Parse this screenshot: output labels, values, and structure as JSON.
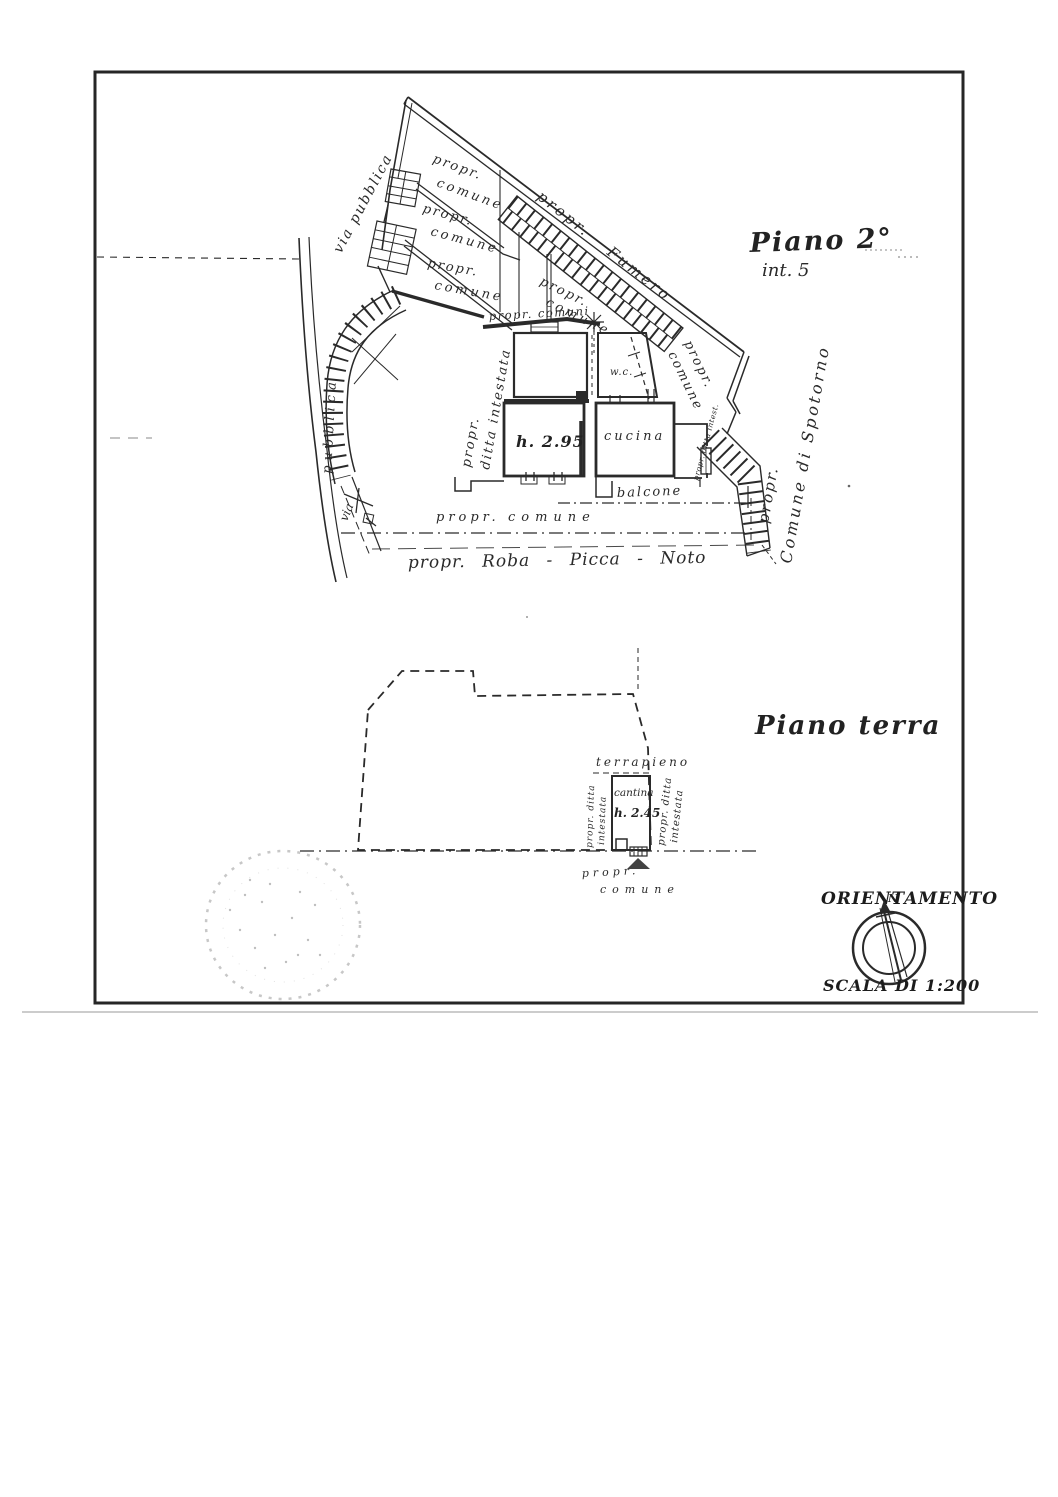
{
  "document": {
    "kind": "Scanned cadastral floor plan sheet",
    "ink_color": "#2a2a2a",
    "paper_color": "#ffffff"
  },
  "upper_plan": {
    "title": "Piano 2°",
    "subtitle": "int. 5",
    "road_label": "via pubblica",
    "road_label_curve": "pubblica",
    "road_label_short": "via",
    "neighbor_top": "propr. Fumero",
    "neighbor_right_line1": "propr.",
    "neighbor_right_line2": "Comune di Spotorno",
    "parcels": [
      {
        "line1": "propr.",
        "line2": "comune"
      },
      {
        "line1": "propr.",
        "line2": "comune"
      },
      {
        "line1": "propr.",
        "line2": "comune"
      },
      {
        "line1": "propr.",
        "line2": "comune"
      },
      {
        "line1": "propr.",
        "line2": "comune"
      }
    ],
    "strip_label": "propr. comuni",
    "apartment": {
      "owner_line1": "propr.",
      "owner_line2": "ditta intestata",
      "room_height": "h. 2.95",
      "kitchen": "cucina",
      "wc": "w.c.",
      "balcony": "balcone",
      "stair_owner": "propr. ditta intest."
    },
    "bottom_owner_line1": "propr.",
    "bottom_owner_line2": "comune",
    "bottom_neighbors": "propr. Roba - Picca - Noto"
  },
  "lower_plan": {
    "title": "Piano terra",
    "embankment": "terrapieno",
    "cellar": "cantina",
    "cellar_height": "h. 2.45",
    "owner_left_line1": "propr. ditta",
    "owner_left_line2": "intestata",
    "owner_right_line1": "propr. ditta",
    "owner_right_line2": "intestata",
    "bottom_owner_line1": "propr.",
    "bottom_owner_line2": "comune"
  },
  "legend": {
    "orientation_title": "ORIENTAMENTO",
    "north_letter": "N",
    "scale_label": "SCALA DI 1:200"
  }
}
